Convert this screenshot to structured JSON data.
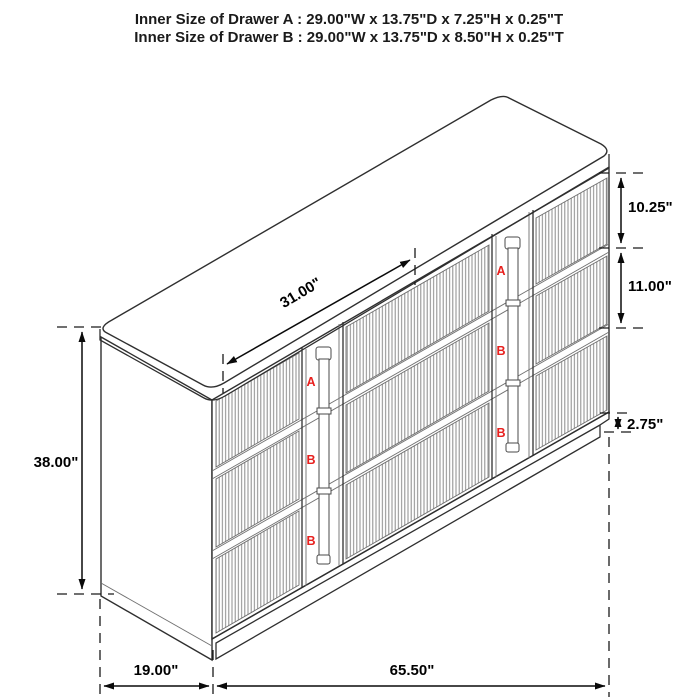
{
  "title": {
    "line_a": "Inner Size of Drawer A : 29.00\"W x 13.75\"D x 7.25\"H x 0.25\"T",
    "line_b": "Inner Size of Drawer B : 29.00\"W x 13.75\"D x 8.50\"H x 0.25\"T"
  },
  "dimensions": {
    "drawer_front_width": "31.00\"",
    "overall_height": "38.00\"",
    "drawer_a_front_height": "10.25\"",
    "drawer_b_front_height": "11.00\"",
    "base_height": "2.75\"",
    "depth": "19.00\"",
    "overall_width": "65.50\""
  },
  "drawer_labels": {
    "left_column": [
      "A",
      "B",
      "B"
    ],
    "right_column": [
      "A",
      "B",
      "B"
    ]
  },
  "colors": {
    "label_red": "#e8201e",
    "outline": "#2f2f2f",
    "dimension_line": "#0a0a0a",
    "flute_line": "#8c8c8c",
    "background": "#ffffff"
  }
}
